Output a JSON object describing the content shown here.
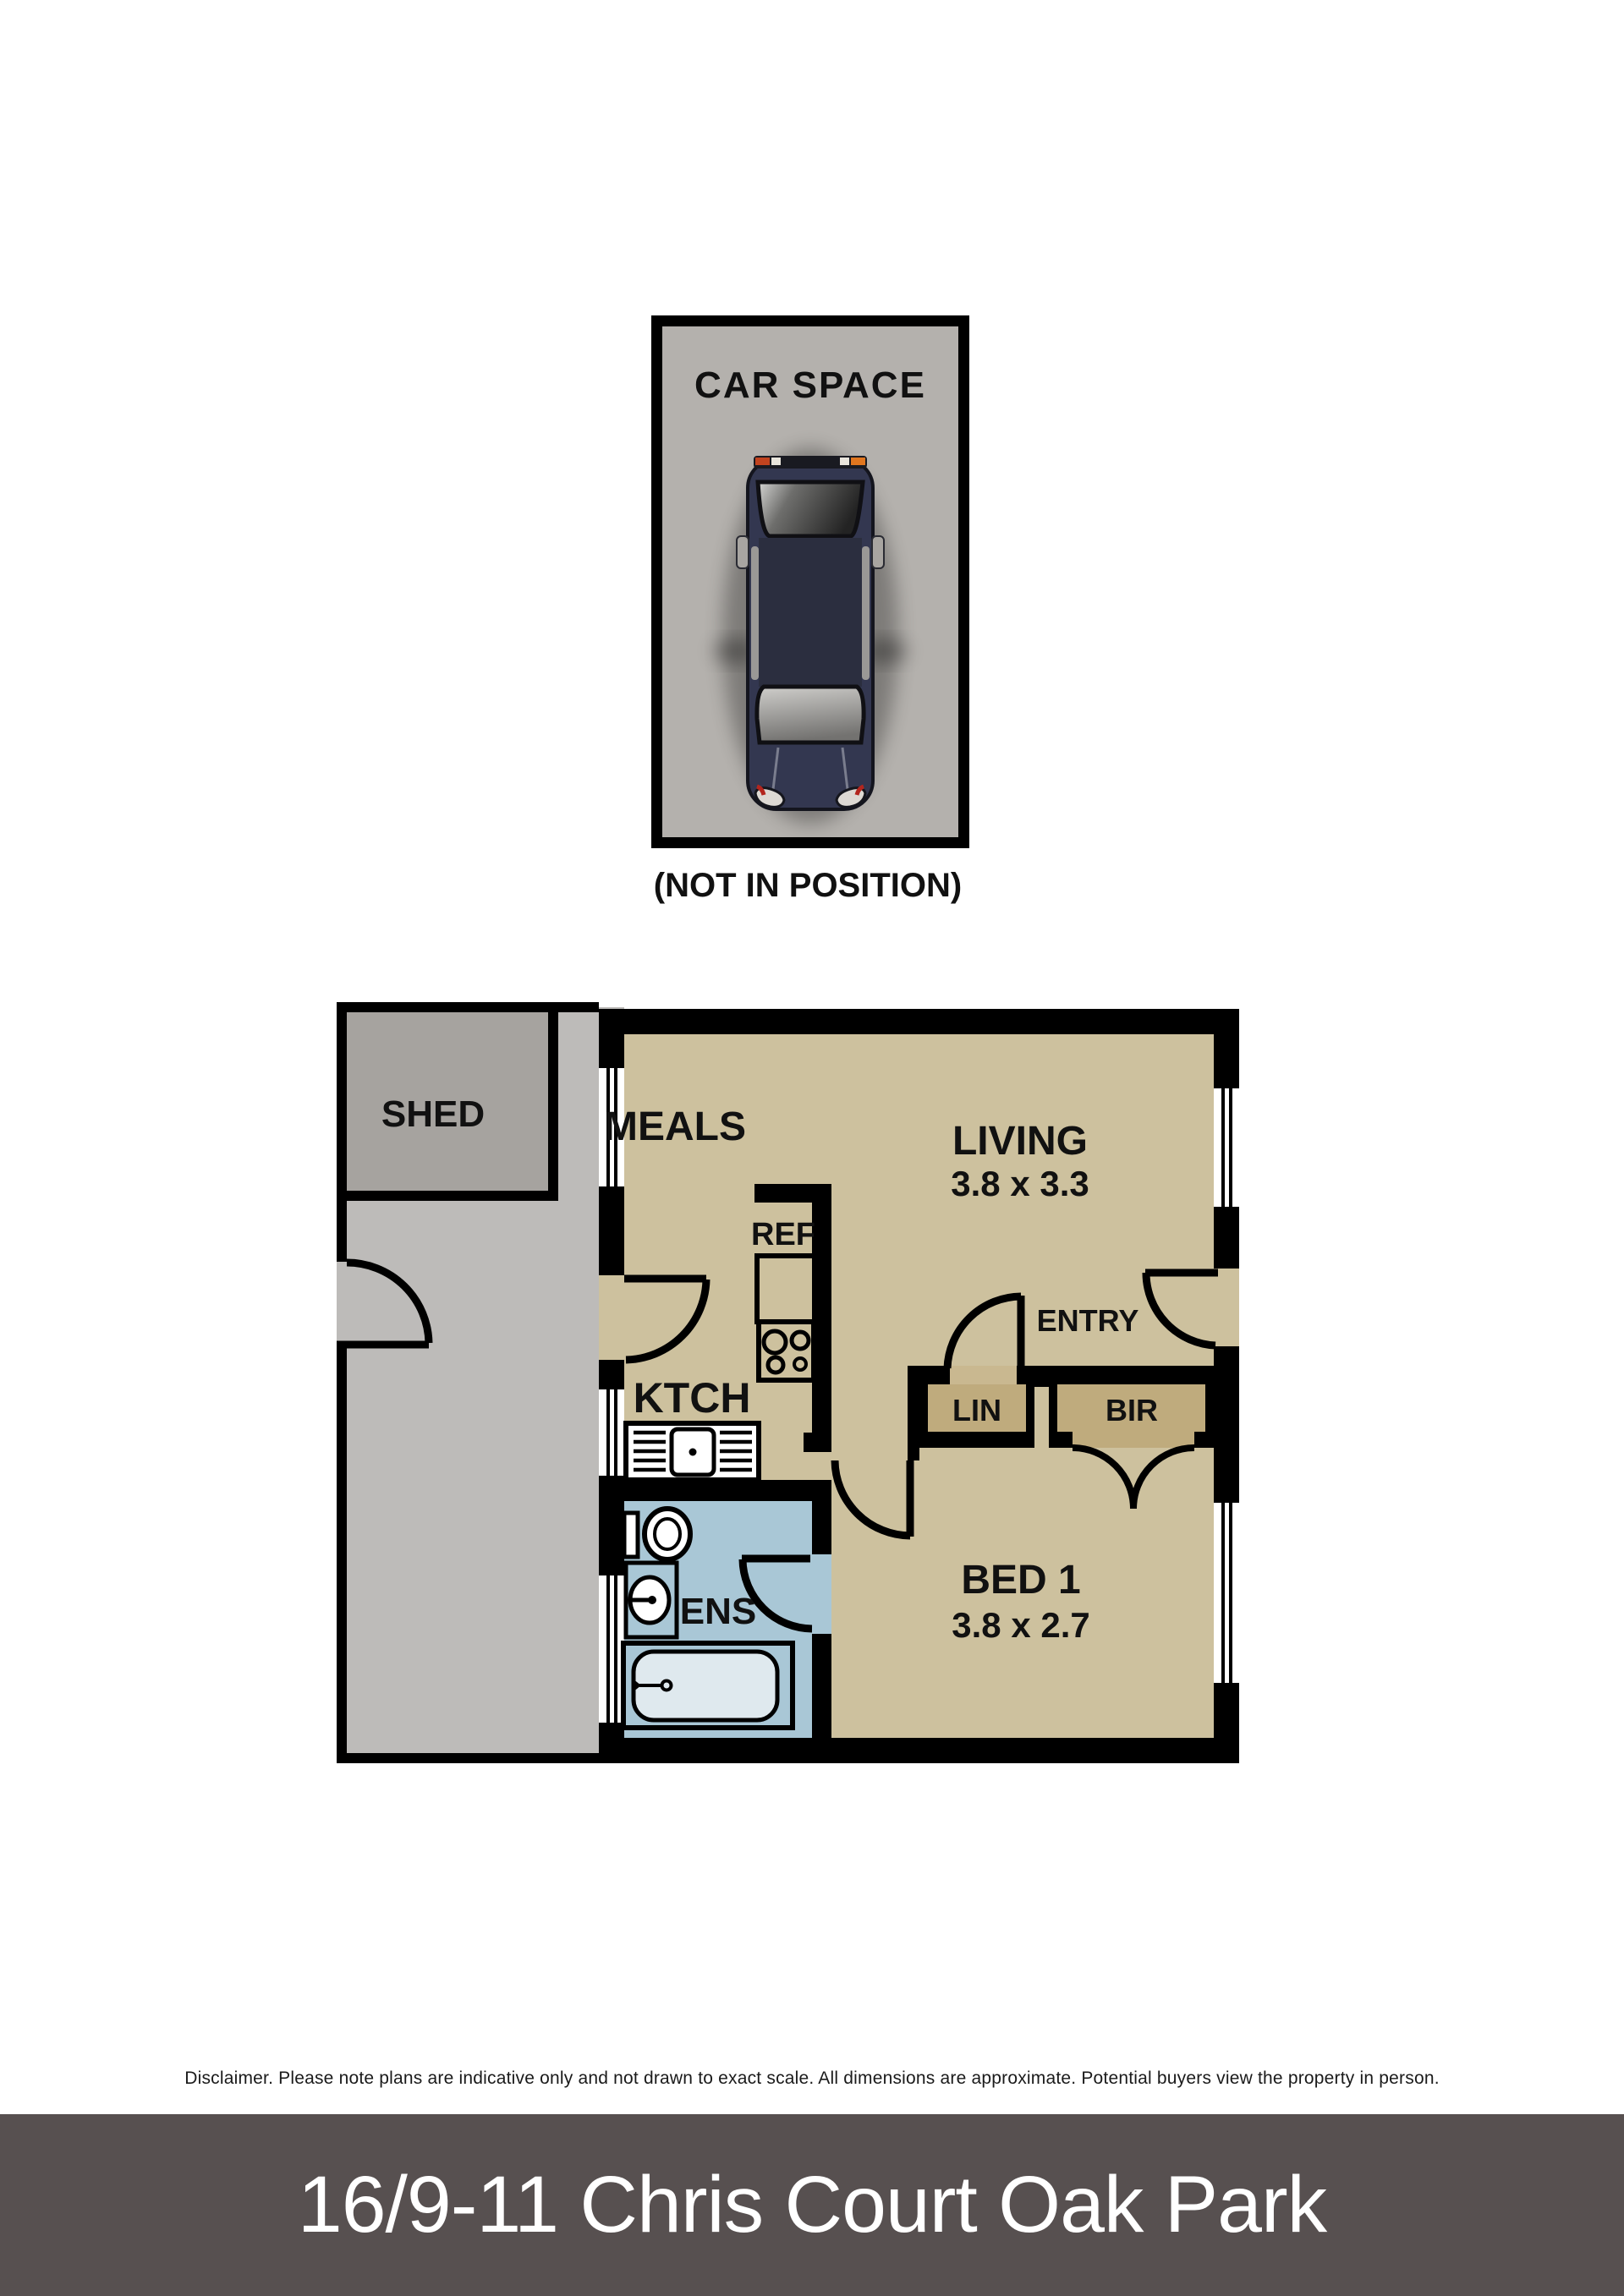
{
  "carspace": {
    "title": "CAR SPACE",
    "note": "(NOT IN POSITION)"
  },
  "plan": {
    "shed": "SHED",
    "meals": "MEALS",
    "living": "LIVING",
    "living_dims": "3.8 x 3.3",
    "ref": "REF",
    "ktch": "KTCH",
    "entry": "ENTRY",
    "lin": "LIN",
    "bir": "BIR",
    "bed1": "BED 1",
    "bed1_dims": "3.8 x 2.7",
    "ens": "ENS"
  },
  "disclaimer": "Disclaimer. Please note plans are indicative only and not drawn to exact scale. All dimensions are approximate. Potential buyers view the property in person.",
  "footer": {
    "address": "16/9-11 Chris Court Oak Park"
  },
  "colors": {
    "room_tan": "#cdc19e",
    "closet_tan": "#bfab7d",
    "door_gap_tan": "#c9b890",
    "ens_blue": "#a9c7d6",
    "outdoor_gray": "#bdbbb9",
    "shed_gray": "#a6a39f",
    "carspace_gray": "#b4b1ad",
    "wall_black": "#000000",
    "footer_bg": "#575050",
    "car_body": "#333750"
  }
}
